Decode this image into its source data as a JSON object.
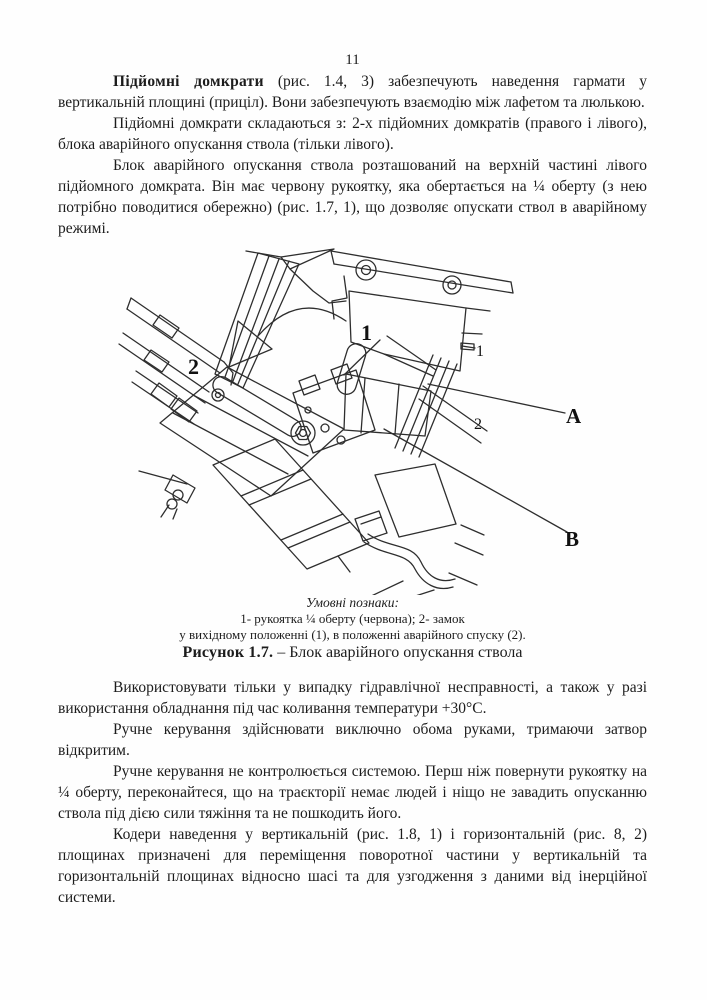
{
  "page": {
    "number": "11"
  },
  "content": {
    "p1_bold": "Підйомні домкрати",
    "p1_rest": " (рис. 1.4, 3) забезпечують наведення гармати у вертикальній площині (приціл). Вони забезпечують взаємодію між лафетом та люлькою.",
    "p2": "Підйомні домкрати складаються з: 2-х підйомних домкратів (правого і лівого), блока аварійного опускання ствола (тільки лівого).",
    "p3": "Блок аварійного опускання ствола розташований на верхній частині лівого підйомного домкрата. Він має червону рукоятку, яка обертається на ¼ оберту (з нею потрібно поводитися обережно) (рис. 1.7, 1), що дозволяє опускати ствол в аварійному режимі."
  },
  "figure": {
    "labels": {
      "item1": "1",
      "item2": "2",
      "pos1": "1",
      "pos2": "2",
      "view_a": "A",
      "view_b": "B"
    },
    "legend_title": "Умовні познаки:",
    "legend_line1": "1- рукоятка ¼ оберту (червона); 2- замок",
    "legend_line2": "у вихідному положенні (1), в положенні аварійного спуску (2).",
    "caption_label": "Рисунок 1.7.",
    "caption_text": " – Блок аварійного опускання ствола"
  },
  "content_after": {
    "p4": "Використовувати тільки у випадку гідравлічної несправності, а також у разі використання обладнання під час коливання температури +30°С.",
    "p5": "Ручне керування здійснювати виключно обома руками, тримаючи затвор відкритим.",
    "p6": "Ручне керування не контролюється системою. Перш ніж повернути рукоятку на ¼ оберту, переконайтеся, що на траєкторії немає людей і ніщо не завадить опусканню ствола під дією сили тяжіння та не пошкодить його.",
    "p7": "Кодери наведення у вертикальній (рис. 1.8, 1) і горизонтальній (рис. 8, 2) площинах призначені для переміщення поворотної частини у вертикальній та горизонтальній площинах відносно шасі та для узгодження з даними від інерційної системи."
  }
}
